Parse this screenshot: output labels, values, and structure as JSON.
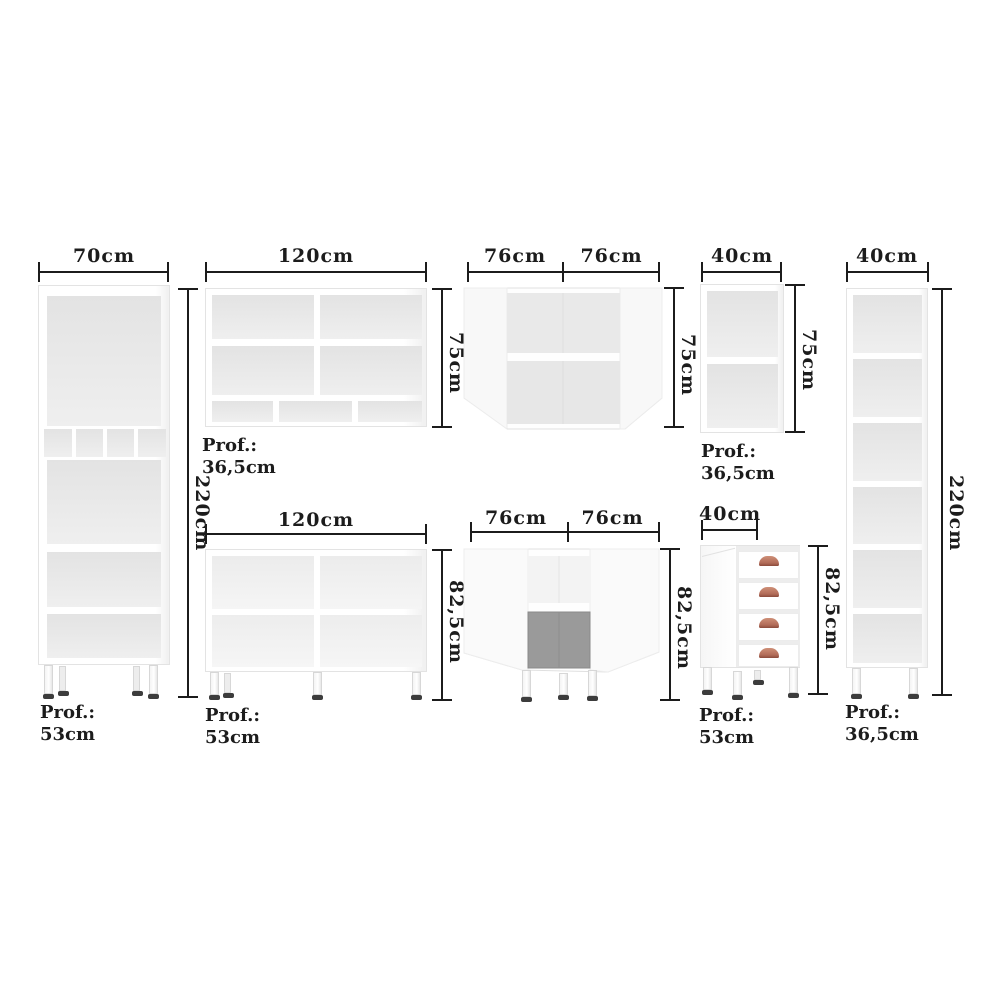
{
  "diagram": {
    "kind": "furniture-dimension-diagram",
    "background": "#ffffff"
  },
  "colors": {
    "dimension_line": "#1c1c1c",
    "label_text": "#1c1c1c",
    "cabinet_fill": "#ffffff",
    "cabinet_border": "#e3e3e3",
    "interior_shade": "#e8e8e8",
    "interior_dark": "#979797",
    "drawer_handle": "#b16b58",
    "leg_foot": "#3c3c3c"
  },
  "modules": [
    {
      "name": "tall-cabinet-70",
      "width_label": "70cm",
      "height_label": "220cm",
      "depth_label": "Prof.:",
      "depth_value": "53cm"
    },
    {
      "name": "wall-cabinet-120",
      "width_label": "120cm",
      "height_label": "75cm",
      "depth_label": "Prof.:",
      "depth_value": "36,5cm"
    },
    {
      "name": "corner-wall-cabinet-76",
      "width_label_left": "76cm",
      "width_label_right": "76cm",
      "height_label": "75cm"
    },
    {
      "name": "wall-cabinet-40",
      "width_label": "40cm",
      "height_label": "75cm",
      "depth_label": "Prof.:",
      "depth_value": "36,5cm"
    },
    {
      "name": "tall-cabinet-40",
      "width_label": "40cm",
      "height_label": "220cm",
      "depth_label": "Prof.:",
      "depth_value": "36,5cm"
    },
    {
      "name": "base-cabinet-120",
      "width_label": "120cm",
      "height_label": "82,5cm",
      "depth_label": "Prof.:",
      "depth_value": "53cm"
    },
    {
      "name": "corner-base-cabinet-76",
      "width_label_left": "76cm",
      "width_label_right": "76cm",
      "height_label": "82,5cm"
    },
    {
      "name": "drawer-base-cabinet-40",
      "width_label": "40cm",
      "height_label": "82,5cm",
      "depth_label": "Prof.:",
      "depth_value": "53cm"
    }
  ]
}
